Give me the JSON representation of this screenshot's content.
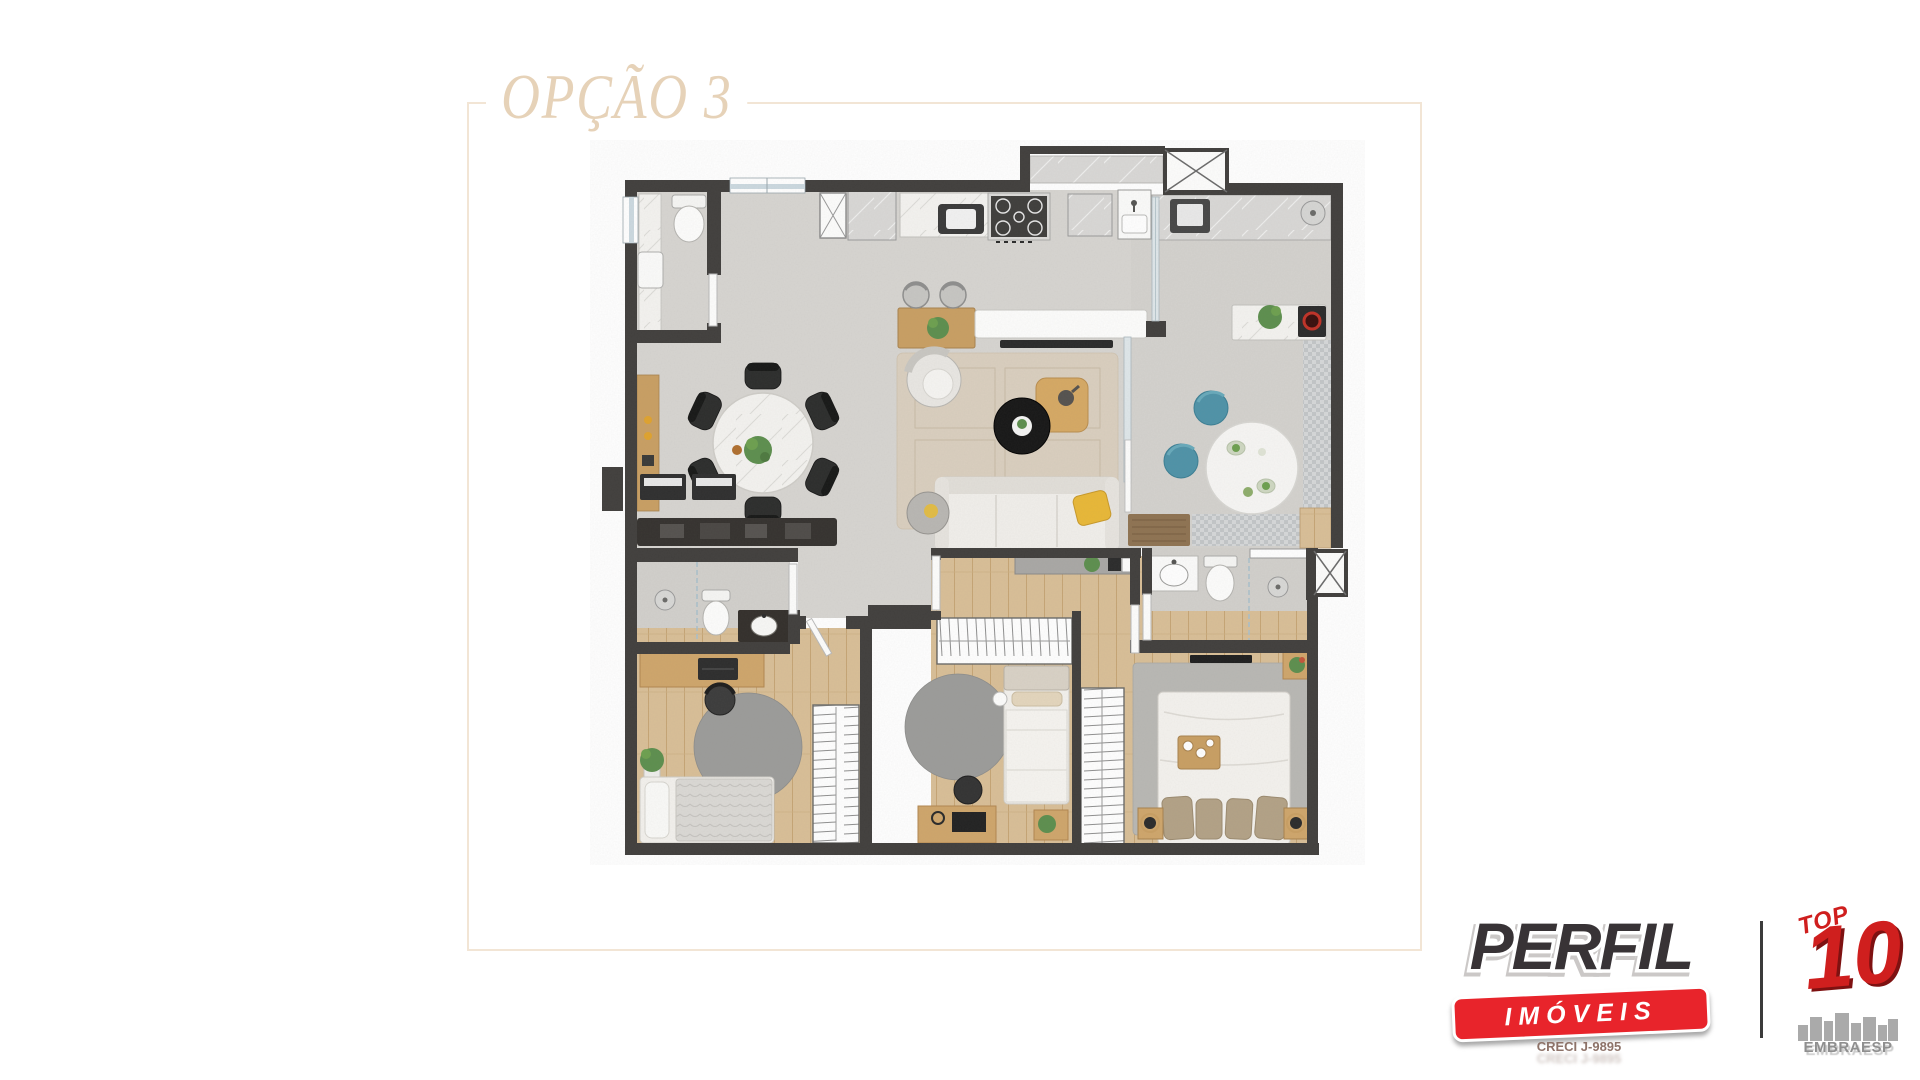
{
  "title": {
    "text": "OPÇÃO 3"
  },
  "frame": {
    "line_color": "#f2e5d5",
    "title_color": "#e6d2b8"
  },
  "branding": {
    "perfil": {
      "wordmark": "PERFIL",
      "tagline": "IMÓVEIS",
      "registration": "CRECI J-9895",
      "wordmark_color": "#383336",
      "brand_red": "#e8242b"
    },
    "embraesp": {
      "script": "TOP",
      "number": "10",
      "name": "EMBRAESP",
      "brand_red": "#cf1f1e",
      "text_gray": "#8f8f8f"
    }
  },
  "floor_plan": {
    "colors": {
      "wall": "#413f3d",
      "concrete_floor": "#d7d5d1",
      "terrace_floor": "#d4d2ce",
      "bathroom_floor": "#d2d0cc",
      "wood_floor": "#d9bf97",
      "marble": "#f4f3f0",
      "rug_beige": "#dacfbf",
      "rug_gray": "#9c9c9a",
      "teal_pouf": "#4f93a8",
      "yellow_accent": "#e9b837",
      "plant_green": "#5d8f4e",
      "window_glass": "#ccd9e0"
    },
    "rooms": [
      {
        "id": "bathroom-1",
        "furniture": [
          "toilet",
          "marble-vanity",
          "window"
        ]
      },
      {
        "id": "dining-area",
        "furniture": [
          "round-marble-table",
          "six-black-chairs",
          "wood-sideboard",
          "media-console",
          "keyboards"
        ]
      },
      {
        "id": "kitchen",
        "furniture": [
          "gas-stove",
          "sink",
          "counter",
          "fridge-cabinet",
          "island-with-tv",
          "bar-stools"
        ]
      },
      {
        "id": "living-area",
        "furniture": [
          "sofa",
          "yellow-cushion",
          "black-coffee-table",
          "wood-tray-table",
          "armchair",
          "beige-rug",
          "side-pouf"
        ]
      },
      {
        "id": "terrace-gourmet",
        "furniture": [
          "marble-counter",
          "bar-counter-with-grill",
          "round-table",
          "teal-poufs",
          "checkered-rug",
          "doormats"
        ]
      },
      {
        "id": "hallway",
        "furniture": []
      },
      {
        "id": "bathroom-2",
        "furniture": [
          "shower",
          "toilet",
          "dark-vanity"
        ]
      },
      {
        "id": "bedroom-1",
        "furniture": [
          "single-bed",
          "desk",
          "office-chair",
          "round-rug",
          "wardrobe",
          "plant"
        ]
      },
      {
        "id": "bedroom-2",
        "furniture": [
          "single-bed",
          "desk",
          "office-chair",
          "round-rug",
          "wardrobe",
          "console",
          "nightstand-plant"
        ]
      },
      {
        "id": "master-suite",
        "furniture": [
          "double-bed",
          "breakfast-tray",
          "nightstands",
          "gray-rug",
          "wardrobe",
          "tv",
          "corner-shelf"
        ]
      },
      {
        "id": "master-bathroom",
        "furniture": [
          "vanity",
          "toilet",
          "shower",
          "towel-bar"
        ]
      }
    ]
  }
}
